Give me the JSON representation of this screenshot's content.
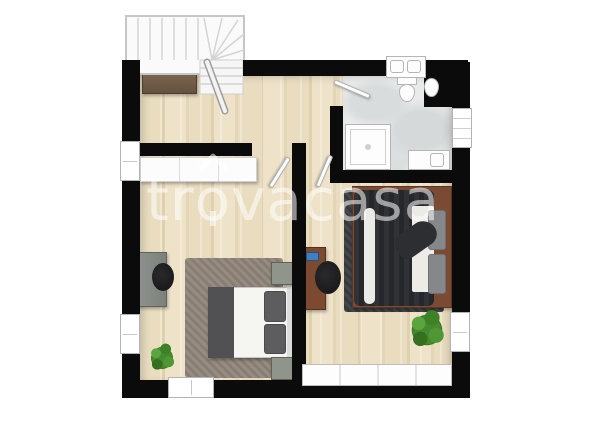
{
  "watermark": {
    "full_text": "trovacasa",
    "text_before_logo": "tr",
    "logo_letter": "o",
    "text_after_logo": "vacasa"
  },
  "colors": {
    "wall": "#0b0b0b",
    "wood_floor": "#e7dabc",
    "bath_floor": "#e9ebeb",
    "rug_left": "#8f8579",
    "rug_right": "#3e4043",
    "bed_left_blanket": "#515153",
    "bed_right_duvet": "#26272a",
    "bed_frame_brown": "#7b4a32",
    "desk_brown": "#7c4a31",
    "furniture_gray": "#878b86",
    "nightstand_green_gray": "#90958b",
    "plant_green": "#3e7a2c",
    "sideboard_brown": "#6b5844",
    "watermark": "rgba(255,255,255,0.55)"
  },
  "plan": {
    "type": "floor-plan",
    "rooms": [
      {
        "name": "hallway-landing",
        "features": [
          "winder-staircase",
          "stair-railing",
          "sideboard",
          "wood-floor"
        ]
      },
      {
        "name": "bathroom",
        "features": [
          "double-sink-niche",
          "toilet",
          "bidet",
          "shower",
          "storage-unit",
          "wall-shelf",
          "door",
          "marble-floor"
        ]
      },
      {
        "name": "bedroom-left",
        "features": [
          "wardrobe",
          "desk",
          "chair",
          "shag-rug",
          "double-bed",
          "two-nightstands",
          "plant",
          "two-windows"
        ]
      },
      {
        "name": "bedroom-right",
        "features": [
          "desk",
          "office-chair",
          "dark-rug",
          "double-bed-wood-frame",
          "jacket-on-bed",
          "plant",
          "window",
          "large-bottom-window"
        ]
      }
    ]
  }
}
